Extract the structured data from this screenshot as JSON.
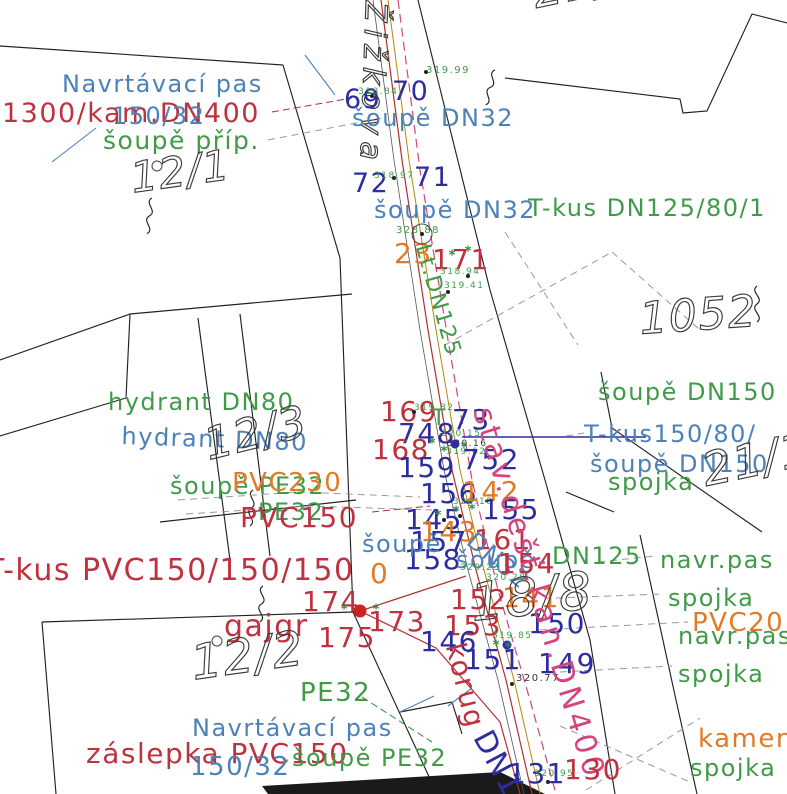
{
  "colors": {
    "blue": "#4d82b8",
    "navy": "#2d2da0",
    "red": "#c0313f",
    "green": "#3f9b48",
    "orange": "#e07b28",
    "magenta": "#d5447c",
    "dark": "#333333",
    "gray": "#999999",
    "ochre": "#b8860b",
    "lineRed": "#b03030",
    "parcelOutline": "#3a3a3a"
  },
  "street": {
    "name_label": "Žižkova"
  },
  "labels": [
    {
      "t": "Navrtávací pas",
      "c": "blue",
      "x": 62,
      "y": 72,
      "fs": 24,
      "n": "pipe-label-navrtavaci-pas-top"
    },
    {
      "t": "1300/kam.DN400",
      "c": "red",
      "x": 2,
      "y": 100,
      "fs": 27,
      "n": "pipe-label-kam-dn400"
    },
    {
      "t": "150/32",
      "c": "blue",
      "x": 112,
      "y": 104,
      "fs": 24,
      "n": "pipe-label-150-32-top"
    },
    {
      "t": "šoupě příp.",
      "c": "green",
      "x": 103,
      "y": 128,
      "fs": 25,
      "n": "pipe-label-soupe-prip"
    },
    {
      "t": "12/1",
      "c": "parcel",
      "x": 128,
      "y": 158,
      "fs": 42,
      "rot": -8,
      "n": "parcel-number-12-1"
    },
    {
      "t": "Žižkova",
      "c": "parcel",
      "x": 390,
      "y": 2,
      "fs": 30,
      "rot": 92,
      "ls": 7,
      "n": "street-name-label"
    },
    {
      "t": "69",
      "c": "navy",
      "x": 344,
      "y": 86,
      "fs": 27,
      "n": "point-number-69"
    },
    {
      "t": "318.84",
      "c": "green",
      "x": 358,
      "y": 88,
      "fs": 9,
      "n": "elevation-label"
    },
    {
      "t": "70",
      "c": "navy",
      "x": 392,
      "y": 78,
      "fs": 27,
      "n": "point-number-70"
    },
    {
      "t": "319.99",
      "c": "green",
      "x": 426,
      "y": 66,
      "fs": 10,
      "n": "elevation-label"
    },
    {
      "t": "šoupě DN32",
      "c": "blue",
      "x": 352,
      "y": 106,
      "fs": 24,
      "n": "pipe-label-soupe-dn32-1"
    },
    {
      "t": "72",
      "c": "navy",
      "x": 352,
      "y": 170,
      "fs": 27,
      "n": "point-number-72"
    },
    {
      "t": "318.97",
      "c": "green",
      "x": 374,
      "y": 172,
      "fs": 9,
      "n": "elevation-label"
    },
    {
      "t": "71",
      "c": "navy",
      "x": 414,
      "y": 164,
      "fs": 27,
      "n": "point-number-71"
    },
    {
      "t": "šoupě DN32",
      "c": "blue",
      "x": 374,
      "y": 198,
      "fs": 24,
      "n": "pipe-label-soupe-dn32-2"
    },
    {
      "t": "T-kus DN125/80/1",
      "c": "green",
      "x": 528,
      "y": 196,
      "fs": 24,
      "n": "pipe-label-tkus-dn125-80"
    },
    {
      "t": "328.88",
      "c": "green",
      "x": 396,
      "y": 226,
      "fs": 10,
      "n": "elevation-label"
    },
    {
      "t": "23",
      "c": "orange",
      "x": 394,
      "y": 240,
      "fs": 28,
      "n": "point-number-23"
    },
    {
      "t": "171",
      "c": "red",
      "x": 432,
      "y": 246,
      "fs": 28,
      "n": "point-number-171"
    },
    {
      "t": "318.94",
      "c": "green",
      "x": 440,
      "y": 268,
      "fs": 9,
      "n": "elevation-label"
    },
    {
      "t": "319.41",
      "c": "green",
      "x": 444,
      "y": 282,
      "fs": 9,
      "n": "elevation-label"
    },
    {
      "t": "Lt.DN125",
      "c": "green",
      "x": 432,
      "y": 242,
      "fs": 22,
      "rot": 74,
      "n": "pipe-label-lt-dn125"
    },
    {
      "t": "1052",
      "c": "parcel",
      "x": 638,
      "y": 298,
      "fs": 44,
      "rot": -4,
      "n": "parcel-number-1052"
    },
    {
      "t": "21/1",
      "c": "parcel",
      "x": 528,
      "y": -30,
      "fs": 46,
      "rot": -12,
      "n": "parcel-number-21-1-top"
    },
    {
      "t": "hydrant DN80",
      "c": "green",
      "x": 108,
      "y": 390,
      "fs": 24,
      "n": "pipe-label-hydrant-dn80-green"
    },
    {
      "t": "hydrant DN80",
      "c": "blue",
      "x": 122,
      "y": 424,
      "fs": 24,
      "rot": 2,
      "n": "pipe-label-hydrant-dn80-blue"
    },
    {
      "t": "12/3",
      "c": "parcel",
      "x": 200,
      "y": 425,
      "fs": 44,
      "rot": -14,
      "n": "parcel-number-12-3"
    },
    {
      "t": "šoupě PE32",
      "c": "green",
      "x": 170,
      "y": 474,
      "fs": 24,
      "n": "pipe-label-soupe-pe32"
    },
    {
      "t": "PVC230",
      "c": "orange",
      "x": 232,
      "y": 470,
      "fs": 26,
      "n": "pipe-label-pvc230"
    },
    {
      "t": "PE32",
      "c": "green",
      "x": 258,
      "y": 500,
      "fs": 24,
      "n": "pipe-label-pe32-mid"
    },
    {
      "t": "PVC150",
      "c": "red",
      "x": 240,
      "y": 504,
      "fs": 28,
      "n": "pipe-label-pvc150"
    },
    {
      "t": "169",
      "c": "red",
      "x": 380,
      "y": 398,
      "fs": 28,
      "n": "point-number-169"
    },
    {
      "t": "319.82",
      "c": "green",
      "x": 414,
      "y": 404,
      "fs": 9,
      "n": "elevation-label"
    },
    {
      "t": "T",
      "c": "green",
      "x": 432,
      "y": 408,
      "fs": 22,
      "n": "symbol-t"
    },
    {
      "t": "73",
      "c": "navy",
      "x": 452,
      "y": 406,
      "fs": 28,
      "n": "point-number-73"
    },
    {
      "t": "748",
      "c": "navy",
      "x": 398,
      "y": 420,
      "fs": 28,
      "n": "point-number-748"
    },
    {
      "t": "168",
      "c": "red",
      "x": 372,
      "y": 436,
      "fs": 28,
      "n": "point-number-168"
    },
    {
      "t": "320.15",
      "c": "green",
      "x": 441,
      "y": 430,
      "fs": 9,
      "n": "elevation-label"
    },
    {
      "t": "320.16",
      "c": "dark",
      "x": 447,
      "y": 440,
      "fs": 9,
      "n": "elevation-label"
    },
    {
      "t": "319.62",
      "c": "green",
      "x": 446,
      "y": 448,
      "fs": 9,
      "n": "elevation-label"
    },
    {
      "t": "159",
      "c": "navy",
      "x": 398,
      "y": 454,
      "fs": 28,
      "n": "point-number-159"
    },
    {
      "t": "752",
      "c": "navy",
      "x": 462,
      "y": 446,
      "fs": 28,
      "n": "point-number-752"
    },
    {
      "t": "156",
      "c": "navy",
      "x": 420,
      "y": 480,
      "fs": 28,
      "n": "point-number-156"
    },
    {
      "t": "142",
      "c": "orange",
      "x": 462,
      "y": 478,
      "fs": 28,
      "n": "point-number-142"
    },
    {
      "t": "320.18",
      "c": "green",
      "x": 453,
      "y": 498,
      "fs": 9,
      "n": "elevation-label"
    },
    {
      "t": "155",
      "c": "navy",
      "x": 482,
      "y": 496,
      "fs": 28,
      "n": "point-number-155"
    },
    {
      "t": "145",
      "c": "navy",
      "x": 405,
      "y": 506,
      "fs": 28,
      "n": "point-number-145"
    },
    {
      "t": "143",
      "c": "orange",
      "x": 420,
      "y": 518,
      "fs": 28,
      "n": "point-number-143"
    },
    {
      "t": "157",
      "c": "navy",
      "x": 410,
      "y": 528,
      "fs": 28,
      "n": "point-number-157"
    },
    {
      "t": "158",
      "c": "navy",
      "x": 404,
      "y": 546,
      "fs": 28,
      "n": "point-number-158"
    },
    {
      "t": "šoupě",
      "c": "blue",
      "x": 362,
      "y": 532,
      "fs": 24,
      "n": "pipe-label-soupe-3"
    },
    {
      "t": "0",
      "c": "orange",
      "x": 370,
      "y": 560,
      "fs": 28,
      "n": "point-number-0"
    },
    {
      "t": "161",
      "c": "red",
      "x": 474,
      "y": 526,
      "fs": 28,
      "n": "point-number-161"
    },
    {
      "t": "šoupě",
      "c": "blue",
      "x": 456,
      "y": 548,
      "fs": 24,
      "n": "pipe-label-soupe-4"
    },
    {
      "t": "DN32",
      "c": "blue",
      "x": 478,
      "y": 528,
      "fs": 24,
      "rot": 40,
      "n": "pipe-label-dn32-diagonal"
    },
    {
      "t": "154",
      "c": "red",
      "x": 498,
      "y": 550,
      "fs": 28,
      "n": "point-number-154"
    },
    {
      "t": "DN125",
      "c": "green",
      "x": 552,
      "y": 544,
      "fs": 24,
      "n": "pipe-label-dn125"
    },
    {
      "t": "320.23",
      "c": "green",
      "x": 460,
      "y": 564,
      "fs": 9,
      "n": "elevation-label"
    },
    {
      "t": "320.28",
      "c": "green",
      "x": 486,
      "y": 574,
      "fs": 9,
      "n": "elevation-label"
    },
    {
      "t": "152",
      "c": "red",
      "x": 450,
      "y": 586,
      "fs": 28,
      "n": "point-number-152"
    },
    {
      "t": "141",
      "c": "orange",
      "x": 502,
      "y": 584,
      "fs": 28,
      "n": "point-number-141"
    },
    {
      "t": "18/8",
      "c": "parcel",
      "x": 468,
      "y": 578,
      "fs": 52,
      "rot": -6,
      "n": "parcel-number-18-8"
    },
    {
      "t": "150",
      "c": "navy",
      "x": 528,
      "y": 610,
      "fs": 28,
      "n": "point-number-150"
    },
    {
      "t": "153",
      "c": "red",
      "x": 444,
      "y": 612,
      "fs": 28,
      "n": "point-number-153"
    },
    {
      "t": "146",
      "c": "navy",
      "x": 420,
      "y": 628,
      "fs": 28,
      "n": "point-number-146"
    },
    {
      "t": "319.85",
      "c": "green",
      "x": 492,
      "y": 632,
      "fs": 9,
      "n": "elevation-label"
    },
    {
      "t": "151",
      "c": "navy",
      "x": 464,
      "y": 646,
      "fs": 28,
      "n": "point-number-151"
    },
    {
      "t": "149",
      "c": "navy",
      "x": 538,
      "y": 650,
      "fs": 28,
      "n": "point-number-149"
    },
    {
      "t": "320.77",
      "c": "dark",
      "x": 516,
      "y": 674,
      "fs": 10,
      "n": "elevation-label"
    },
    {
      "t": "korug",
      "c": "red",
      "x": 468,
      "y": 640,
      "fs": 28,
      "rot": 76,
      "n": "pipe-label-korug"
    },
    {
      "t": "stav.dešť.kan.DN400",
      "c": "magenta",
      "x": 496,
      "y": 404,
      "fs": 30,
      "rot": 73,
      "ls": 4,
      "n": "pipe-label-stav-dest-kan-dn400"
    },
    {
      "t": "šoupě DN150",
      "c": "green",
      "x": 598,
      "y": 380,
      "fs": 24,
      "n": "pipe-label-soupe-dn150-green"
    },
    {
      "t": "T-kus150/80/",
      "c": "blue",
      "x": 584,
      "y": 422,
      "fs": 24,
      "n": "pipe-label-tkus-150-80"
    },
    {
      "t": "šoupě DN150",
      "c": "blue",
      "x": 590,
      "y": 452,
      "fs": 24,
      "n": "pipe-label-soupe-dn150-blue"
    },
    {
      "t": "spojka",
      "c": "green",
      "x": 608,
      "y": 470,
      "fs": 24,
      "n": "pipe-label-spojka-1"
    },
    {
      "t": "21/1",
      "c": "parcel",
      "x": 698,
      "y": 448,
      "fs": 46,
      "rot": -12,
      "n": "parcel-number-21-1-right"
    },
    {
      "t": "navr.pas",
      "c": "green",
      "x": 660,
      "y": 548,
      "fs": 24,
      "n": "pipe-label-navr-pas-1"
    },
    {
      "t": "spojka",
      "c": "green",
      "x": 668,
      "y": 586,
      "fs": 24,
      "n": "pipe-label-spojka-2"
    },
    {
      "t": "PVC20",
      "c": "orange",
      "x": 692,
      "y": 610,
      "fs": 26,
      "n": "pipe-label-pvc20"
    },
    {
      "t": "navr.pas",
      "c": "green",
      "x": 678,
      "y": 624,
      "fs": 24,
      "n": "pipe-label-navr-pas-2"
    },
    {
      "t": "spojka",
      "c": "green",
      "x": 678,
      "y": 662,
      "fs": 24,
      "n": "pipe-label-spojka-3"
    },
    {
      "t": "kamen",
      "c": "orange",
      "x": 698,
      "y": 726,
      "fs": 26,
      "n": "pipe-label-kamen"
    },
    {
      "t": "spojka",
      "c": "green",
      "x": 690,
      "y": 756,
      "fs": 24,
      "n": "pipe-label-spojka-4"
    },
    {
      "t": "T-kus PVC150/150/150",
      "c": "red",
      "x": -14,
      "y": 556,
      "fs": 30,
      "n": "pipe-label-tkus-pvc150"
    },
    {
      "t": "174",
      "c": "red",
      "x": 302,
      "y": 588,
      "fs": 28,
      "n": "point-number-174"
    },
    {
      "t": "173",
      "c": "red",
      "x": 368,
      "y": 608,
      "fs": 28,
      "n": "point-number-173"
    },
    {
      "t": "gajgr",
      "c": "red",
      "x": 224,
      "y": 612,
      "fs": 30,
      "n": "pipe-label-gajgr"
    },
    {
      "t": "175",
      "c": "red",
      "x": 318,
      "y": 624,
      "fs": 28,
      "n": "point-number-175"
    },
    {
      "t": "12/2",
      "c": "parcel",
      "x": 188,
      "y": 640,
      "fs": 48,
      "rot": -8,
      "n": "parcel-number-12-2"
    },
    {
      "t": "PE32",
      "c": "green",
      "x": 300,
      "y": 680,
      "fs": 26,
      "n": "pipe-label-pe32-bottom"
    },
    {
      "t": "Navrtávací pas",
      "c": "blue",
      "x": 192,
      "y": 716,
      "fs": 24,
      "n": "pipe-label-navrtavaci-pas-bottom"
    },
    {
      "t": "záslepka PVC150",
      "c": "red",
      "x": 86,
      "y": 740,
      "fs": 28,
      "n": "pipe-label-zaslepka-pvc150"
    },
    {
      "t": "150/32",
      "c": "blue",
      "x": 190,
      "y": 754,
      "fs": 26,
      "n": "pipe-label-150-32-bottom"
    },
    {
      "t": "šoupě PE32",
      "c": "green",
      "x": 292,
      "y": 746,
      "fs": 24,
      "n": "pipe-label-soupe-pe32-bottom"
    },
    {
      "t": "131",
      "c": "navy",
      "x": 508,
      "y": 760,
      "fs": 28,
      "n": "point-number-131"
    },
    {
      "t": "130",
      "c": "red",
      "x": 564,
      "y": 756,
      "fs": 28,
      "n": "point-number-130"
    },
    {
      "t": "320.95",
      "c": "green",
      "x": 534,
      "y": 770,
      "fs": 9,
      "n": "elevation-label"
    },
    {
      "t": "DN1",
      "c": "navy",
      "x": 494,
      "y": 726,
      "fs": 30,
      "rot": 62,
      "n": "pipe-label-dn1-rotated"
    }
  ],
  "points": [
    {
      "x": 360,
      "y": 611,
      "type": "dot-red"
    },
    {
      "x": 455,
      "y": 444,
      "type": "dot-blue"
    },
    {
      "x": 507,
      "y": 645,
      "type": "dot-blue"
    },
    {
      "x": 422,
      "y": 234,
      "type": "ring"
    },
    {
      "x": 422,
      "y": 234,
      "type": "dot-black"
    },
    {
      "x": 217,
      "y": 641,
      "type": "ring-sm"
    },
    {
      "x": 157,
      "y": 166,
      "type": "ring-sm"
    },
    {
      "x": 426,
      "y": 72,
      "type": "dot-black"
    },
    {
      "x": 372,
      "y": 96,
      "type": "dot-black"
    },
    {
      "x": 394,
      "y": 178,
      "type": "dot-black"
    },
    {
      "x": 468,
      "y": 276,
      "type": "dot-black"
    },
    {
      "x": 448,
      "y": 292,
      "type": "dot-black"
    },
    {
      "x": 414,
      "y": 412,
      "type": "dot-black"
    },
    {
      "x": 512,
      "y": 684,
      "type": "dot-black"
    },
    {
      "x": 444,
      "y": 520,
      "type": "dot-black"
    },
    {
      "x": 460,
      "y": 516,
      "type": "dot-black"
    },
    {
      "x": 548,
      "y": 782,
      "type": "dot-black"
    },
    {
      "x": 432,
      "y": 444,
      "type": "tick"
    },
    {
      "x": 444,
      "y": 452,
      "type": "tick"
    },
    {
      "x": 464,
      "y": 448,
      "type": "tick"
    },
    {
      "x": 438,
      "y": 516,
      "type": "tick"
    },
    {
      "x": 456,
      "y": 512,
      "type": "tick"
    },
    {
      "x": 472,
      "y": 510,
      "type": "tick"
    },
    {
      "x": 496,
      "y": 646,
      "type": "tick"
    },
    {
      "x": 508,
      "y": 648,
      "type": "tick"
    },
    {
      "x": 344,
      "y": 610,
      "type": "tick"
    },
    {
      "x": 376,
      "y": 610,
      "type": "tick"
    },
    {
      "x": 468,
      "y": 252,
      "type": "tick"
    },
    {
      "x": 452,
      "y": 256,
      "type": "tick"
    }
  ]
}
